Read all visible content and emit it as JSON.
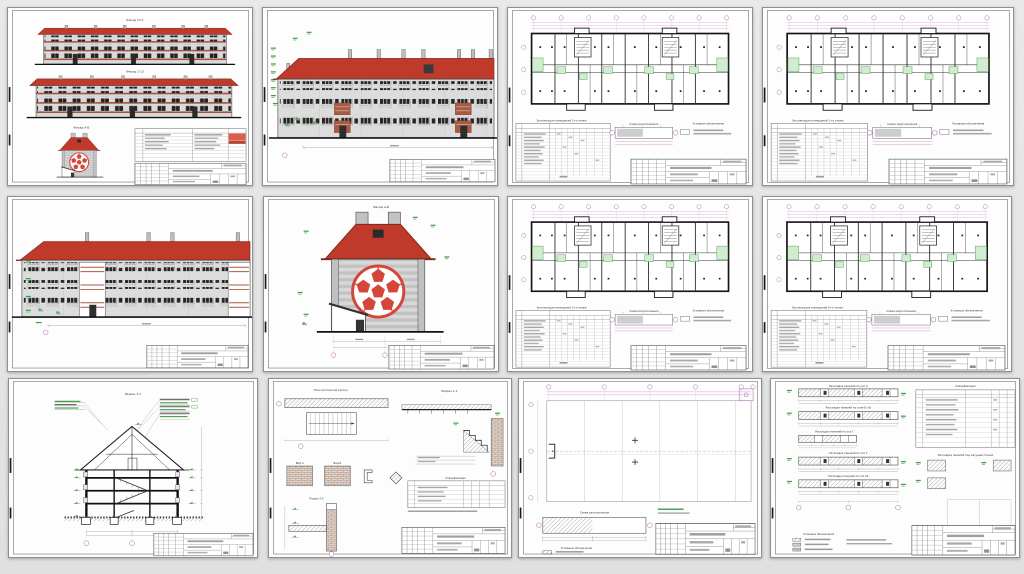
{
  "page": {
    "background": "#e4e4e4"
  },
  "colors": {
    "roof_red": "#bf3a2b",
    "ball_red": "#d6453a",
    "green": "#3f9d3f",
    "green_fill": "#d2ecd2",
    "magenta": "#b05ab0",
    "wall_gray": "#d9d9d9",
    "line_dark": "#222222"
  },
  "sheets": [
    {
      "id": "facades-overview",
      "captions": {
        "c1": "Фасад 13-1",
        "c2": "Фасад 1-13",
        "c3": "Фасад А-Б"
      }
    },
    {
      "id": "facade-fragment-1",
      "captions": {}
    },
    {
      "id": "floor-plan-1",
      "captions": {
        "table": "Экспликация помещений 1-го этажа",
        "schema": "Схема расположения",
        "legend": "Условные обозначения"
      }
    },
    {
      "id": "floor-plan-2",
      "captions": {
        "table": "Экспликация помещений 1-го этажа",
        "schema": "Схема расположения",
        "legend": "Условные обозначения"
      }
    },
    {
      "id": "facade-fragment-2",
      "captions": {}
    },
    {
      "id": "facade-gable",
      "captions": {
        "c1": "Фасад А-Б"
      }
    },
    {
      "id": "floor-plan-3",
      "captions": {
        "table": "Экспликация помещений 2-го этажа",
        "schema": "Схема расположения",
        "legend": "Условные обозначения"
      }
    },
    {
      "id": "floor-plan-4",
      "captions": {
        "table": "Экспликация помещений 3-го этажа",
        "schema": "Схема расположения",
        "legend": "Условные обозначения"
      }
    },
    {
      "id": "section",
      "captions": {
        "c1": "Разрез 1-1"
      }
    },
    {
      "id": "details-stairs",
      "captions": {
        "plan": "План лестничной клетки",
        "section1": "Разрез 1-1",
        "viewA": "Вид А",
        "viewB": "Вид Б",
        "section2": "Разрез 2-2",
        "spec": "Спецификация"
      }
    },
    {
      "id": "framing-plan",
      "captions": {
        "schema": "Схема расположения",
        "legend": "Условные обозначения"
      }
    },
    {
      "id": "panel-layout",
      "captions": {
        "s1": "Раскладка панелей по оси А",
        "s2": "Раскладка панелей по осям Б и В",
        "s3": "Раскладка панелей по оси Г",
        "s4": "Раскладка панелей по оси 1",
        "s5": "Раскладка панелей по оси 14",
        "spec": "Спецификация",
        "detail": "Раскладка панелей под несущей стеной",
        "legend": "Условные обозначения"
      }
    }
  ]
}
